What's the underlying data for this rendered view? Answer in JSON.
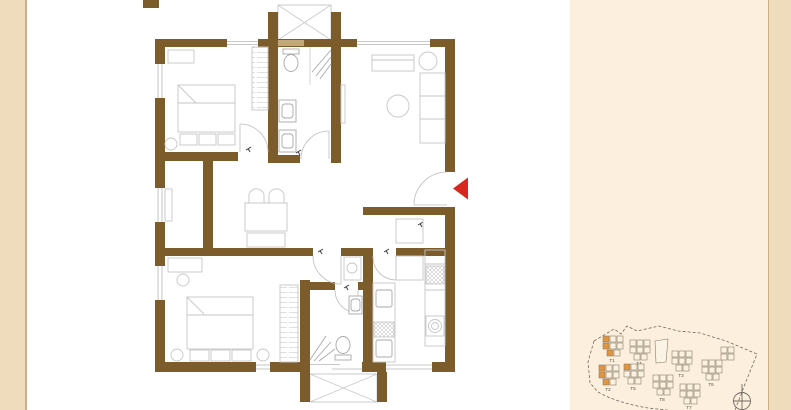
{
  "page": {
    "background": "#ffffff",
    "left_margin_color": "#eedcbd",
    "right_panel_color": "#fcefde",
    "right_strip_color": "#eedcbd",
    "divider_color": "#c9b089"
  },
  "floor_plan": {
    "wall_color": "#7d5c2b",
    "half_wall_color": "#c3a878",
    "furniture_line_color": "#c6c6c6",
    "fixture_line_color": "#a8a8a8",
    "door_symbol_color": "#3a3a3a",
    "entrance_arrow_color": "#d7281f"
  },
  "site_map": {
    "outline_color": "#6f6a5e",
    "building_fill": "#faf1e0",
    "building_stroke": "#8a7f6a",
    "highlight_color": "#e2953e",
    "clusters": [
      {
        "label": "T1",
        "highlighted": true
      },
      {
        "label": "T2",
        "highlighted": true
      },
      {
        "label": "T3",
        "highlighted": false
      },
      {
        "label": "T4",
        "highlighted": false
      },
      {
        "label": "T5",
        "highlighted": true
      },
      {
        "label": "T6",
        "highlighted": false
      },
      {
        "label": "T7",
        "highlighted": false
      },
      {
        "label": "T8",
        "highlighted": false
      }
    ]
  }
}
